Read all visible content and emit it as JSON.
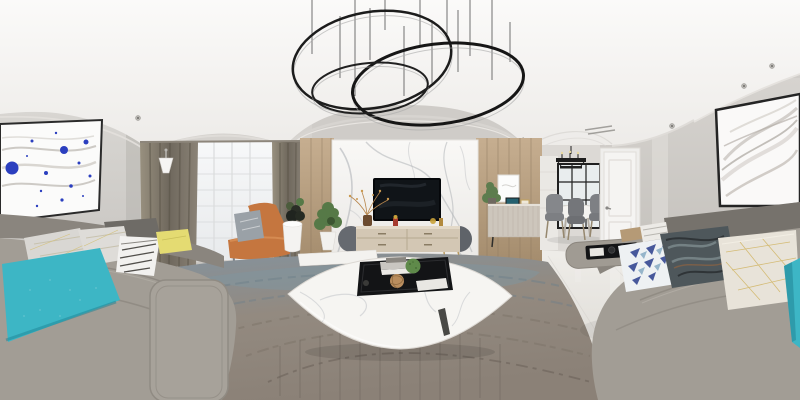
{
  "scene": {
    "subject": "modern living room interior shown as a 360-degree equirectangular panorama",
    "zones": [
      "lounge-sofas",
      "window-curtains",
      "tv-feature-wall",
      "hallway-sideboard",
      "dining-area",
      "entry-door",
      "wall-art"
    ]
  },
  "colors": {
    "ceiling_white": "#faf9f7",
    "wall_gray": "#d2cfcb",
    "floor_marble": "#e9e6e1",
    "wood_panel": "#b59c7e",
    "curtain_taupe": "#877f73",
    "sheer_white": "#f4f5f6",
    "chandelier_black": "#1c1c1c",
    "sofa_gray": "#a29d95",
    "sofa_back_gray": "#8a857e",
    "rug_slate": "#8496a1",
    "rug_taupe": "#9c9287",
    "accent_teal": "#3db6c5",
    "teal_shade": "#1f8596",
    "pillow_yellow": "#e4db72",
    "pillow_navy": "#47589b",
    "chair_orange": "#c5763f",
    "tv_screen": "#101418",
    "console_wood": "#d3c7b4",
    "console_dark": "#666a70",
    "table_marble": "#f6f5f2",
    "tray_black": "#131416",
    "plant_green": "#567947",
    "moss_green": "#5f8a4a",
    "door_white": "#f5f4f2",
    "art_accent_blue": "#2b3fbf",
    "metal_gold": "#b9995c"
  },
  "objects": {
    "chandelier": "three-ring black pendant",
    "tv": "wall-mounted flat screen on marble wall",
    "console": "oval media cabinet",
    "chair": "orange leather accent chair",
    "sofa": "gray wrap-around sectional",
    "rug": "slate and taupe area rug",
    "coffee_table": "white marble low table with black tray",
    "dining": "round table with gray chairs and black pendant",
    "door": "white paneled interior door",
    "art_left": "blue splatter wave print",
    "art_right": "gray silk wave print"
  }
}
